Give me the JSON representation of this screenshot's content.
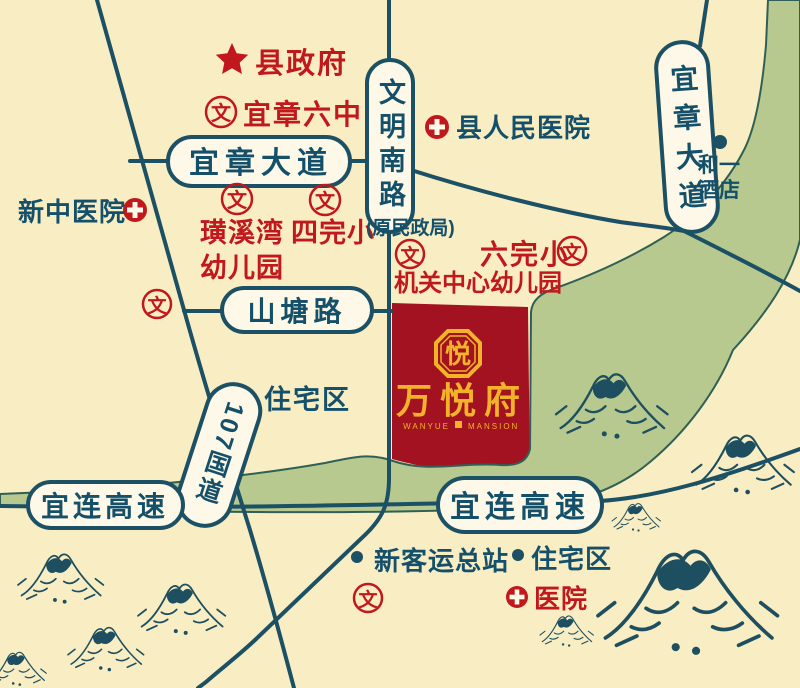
{
  "colors": {
    "background": "#f9edc3",
    "road": "#1b5065",
    "capsule_fill": "#fdf8e7",
    "teal_text": "#15506a",
    "red": "#c0181c",
    "block_red": "#a31220",
    "gold": "#f2b32b",
    "greenbelt": "#b7c98e",
    "ink": "#1d4f60"
  },
  "icons": {
    "school_glyph": "文"
  },
  "project": {
    "name": "万悦府",
    "name_en_left": "WANYUE",
    "name_en_right": "MANSION",
    "logo_char": "悦"
  },
  "roads": {
    "yizhang_avenue": "宜章大道",
    "wenming_south_road": "文明南路",
    "yizhang_avenue_vertical": "宜章大道",
    "shantang_road": "山塘路",
    "g107": "107国道",
    "yilian_expressway_left": "宜连高速",
    "yilian_expressway_right": "宜连高速"
  },
  "pois": {
    "county_government": "县政府",
    "yizhang_no6_middle_school": "宜章六中",
    "county_peoples_hospital": "县人民医院",
    "heyi_hotel_line1": "和一",
    "heyi_hotel_line2": "酒店",
    "xinzhong_hospital": "新中医院",
    "huangxiwan_line1": "璜溪湾",
    "huangxiwan_line2": "幼儿园",
    "no4_primary_school": "四完小",
    "former_civil_affairs_bureau": "(原民政局)",
    "no6_primary_school": "六完小",
    "jiguan_center_kindergarten": "机关中心幼儿园",
    "residential_area_mid": "住宅区",
    "new_bus_terminal": "新客运总站",
    "residential_area_bottom": "住宅区",
    "hospital_bottom": "医院"
  }
}
